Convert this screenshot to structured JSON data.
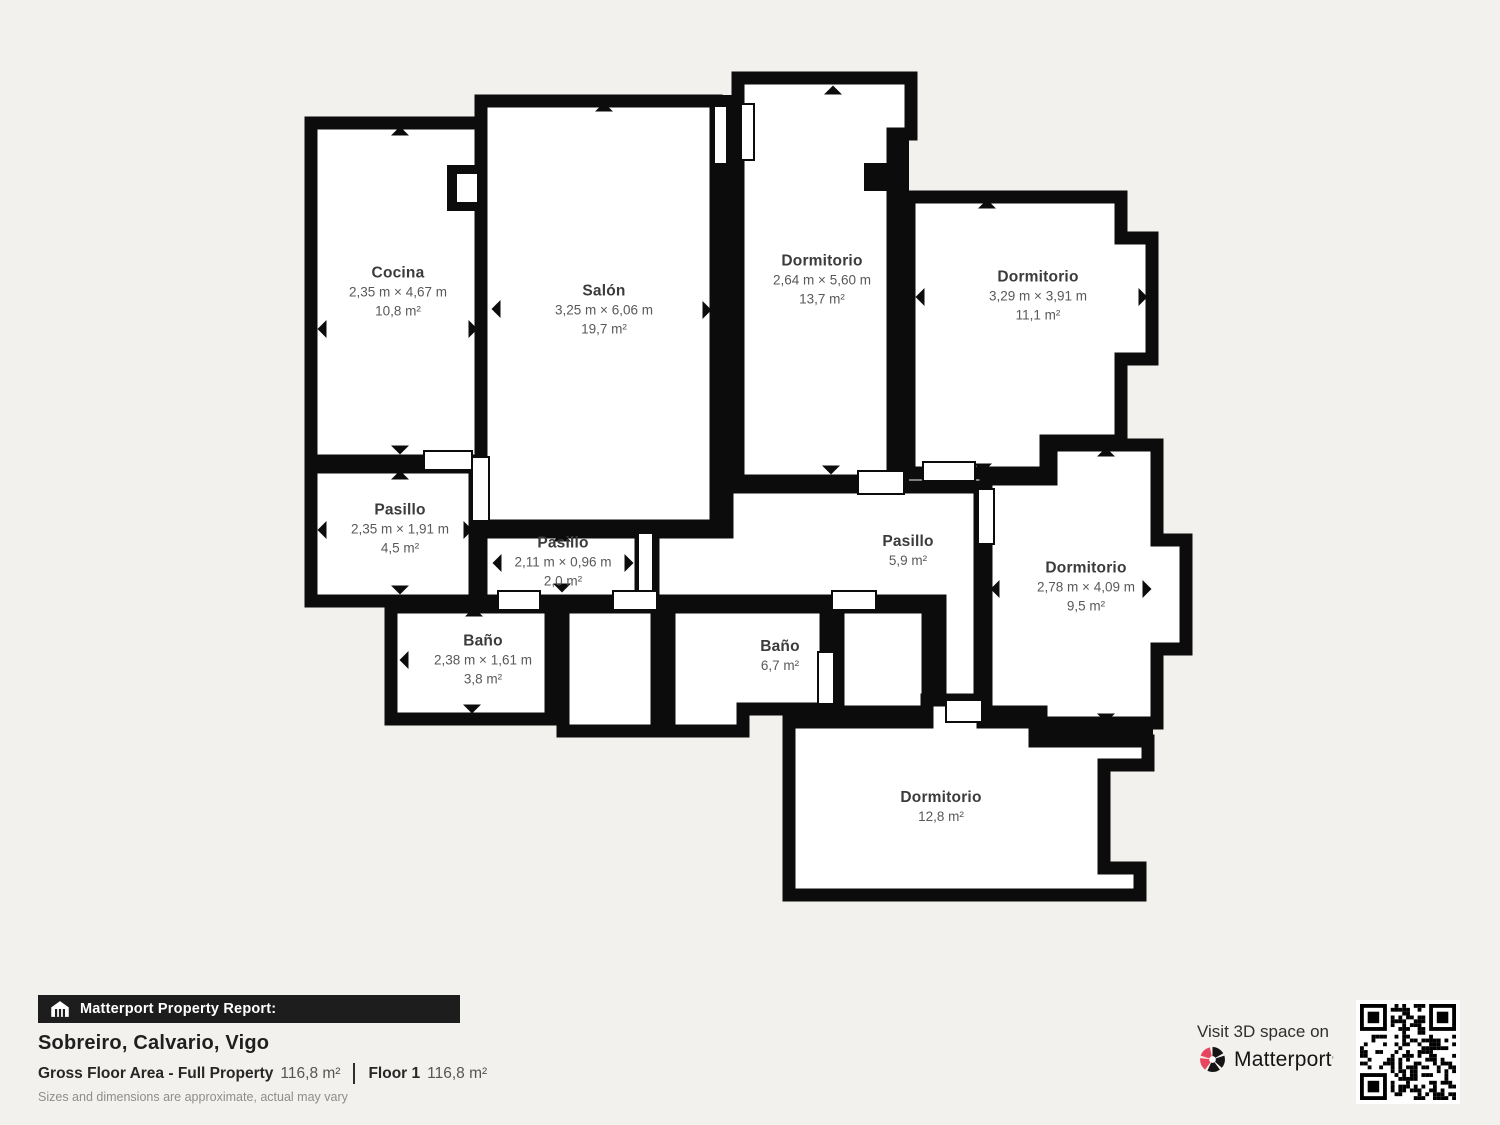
{
  "floorplan": {
    "rooms": [
      {
        "name": "Cocina",
        "dims": "2,35 m × 4,67 m",
        "area": "10,8 m²"
      },
      {
        "name": "Salón",
        "dims": "3,25 m × 6,06 m",
        "area": "19,7 m²"
      },
      {
        "name": "Dormitorio",
        "dims": "2,64 m × 5,60 m",
        "area": "13,7 m²"
      },
      {
        "name": "Dormitorio",
        "dims": "3,29 m × 3,91 m",
        "area": "11,1 m²"
      },
      {
        "name": "Pasillo",
        "dims": "2,35 m × 1,91 m",
        "area": "4,5 m²"
      },
      {
        "name": "Pasillo",
        "dims": "2,11 m × 0,96 m",
        "area": "2,0 m²"
      },
      {
        "name": "Pasillo",
        "area": "5,9 m²"
      },
      {
        "name": "Dormitorio",
        "dims": "2,78 m × 4,09 m",
        "area": "9,5 m²"
      },
      {
        "name": "Baño",
        "dims": "2,38 m × 1,61 m",
        "area": "3,8 m²"
      },
      {
        "name": "Baño",
        "area": "6,7 m²"
      },
      {
        "name": "Dormitorio",
        "area": "12,8 m²"
      }
    ]
  },
  "footer": {
    "report_label": "Matterport Property Report:",
    "address": "Sobreiro, Calvario, Vigo",
    "gfa_label": "Gross Floor Area - Full Property",
    "gfa_value": "116,8 m²",
    "floor_label": "Floor 1",
    "floor_value": "116,8 m²",
    "disclaimer": "Sizes and dimensions are approximate, actual may vary",
    "visit_label": "Visit 3D space on",
    "brand": "Matterport",
    "brand_mark": "’",
    "icons": [
      "house-icon",
      "matterport-logo-icon",
      "qr-code"
    ]
  },
  "colors": {
    "wall": "#0c0c0c",
    "background": "#f2f1ee",
    "room_fill": "#ffffff",
    "accent_red": "#e8455f",
    "bar": "#1d1d1d"
  }
}
